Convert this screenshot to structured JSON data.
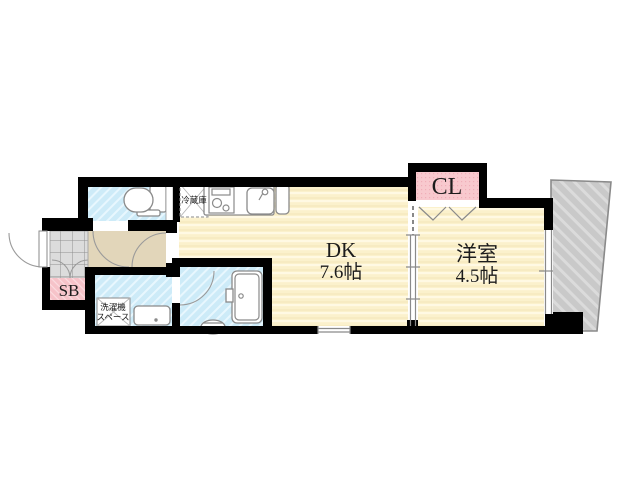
{
  "floorplan": {
    "rooms": {
      "dk": {
        "name": "DK",
        "size": "7.6帖"
      },
      "western_room": {
        "name": "洋室",
        "size": "4.5帖"
      },
      "closet": {
        "label": "CL"
      },
      "shoe_box": {
        "label": "SB"
      },
      "refrigerator": {
        "label": "冷蔵庫"
      },
      "washer_space": {
        "label_line1": "洗濯機",
        "label_line2": "スペース"
      }
    },
    "colors": {
      "room_yellow": "#FBF1CC",
      "stripe_yellow": "#FFF9E3",
      "wet_blue": "#CDEBF8",
      "hall_beige": "#E2D6BA",
      "closet_pink": "#F8C9CE",
      "shoebox_pink": "#F6C3C9",
      "tile_gray": "#DCDCDC",
      "balcony_gray": "#C9C9C9",
      "wall_black": "#000000"
    }
  }
}
